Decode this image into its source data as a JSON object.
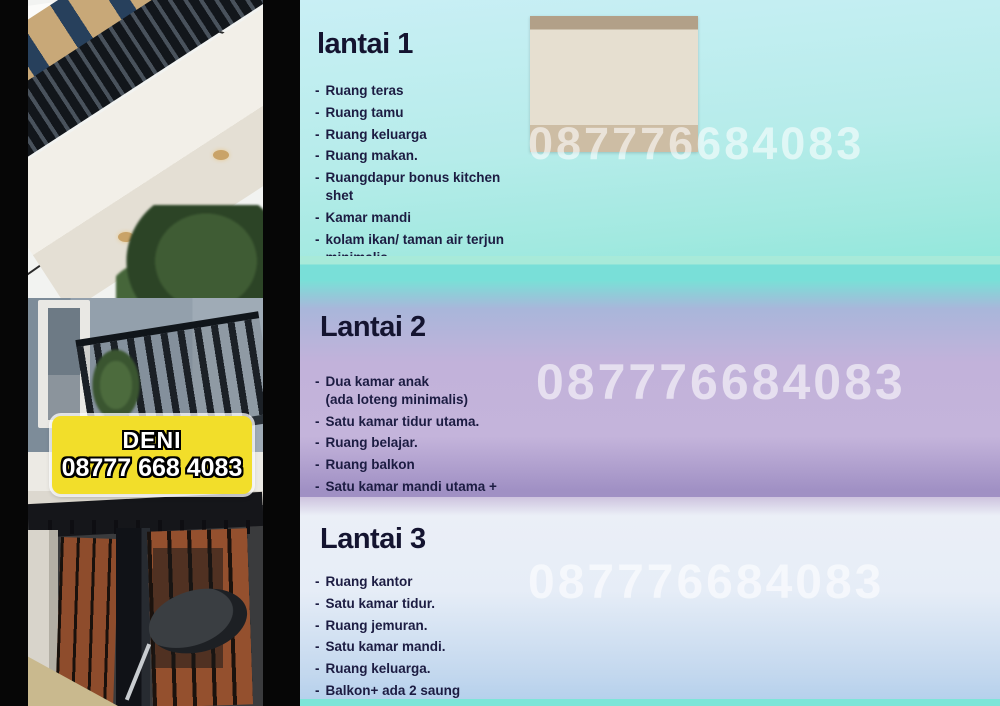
{
  "flyer": {
    "bullet": "-",
    "watermark": "087776684083",
    "badge": {
      "name": "DENI",
      "phone": "08777 668 4083"
    },
    "sections": [
      {
        "title": "lantai 1",
        "items": [
          "Ruang teras",
          "Ruang tamu",
          "Ruang keluarga",
          "Ruang makan.",
          "Ruangdapur bonus kitchen shet",
          "Kamar mandi",
          "kolam ikan/ taman air terjun minimalis.\ncarpot/garasi lantai 1tidak ada,\nhanya adanya teras depan.\n(karena tidak bisa masuk mobil)"
        ],
        "photos": [
          "entrance-double-door",
          "room-ceiling-fan",
          "stone-bathroom-door",
          "white-room",
          "kitchen-set",
          "room-electrical-panel",
          "staircase"
        ]
      },
      {
        "title": "Lantai 2",
        "items": [
          "Dua kamar anak\n(ada loteng minimalis)",
          "Satu kamar tidur utama.",
          "Ruang belajar.",
          "Ruang balkon",
          "Satu kamar mandi utama + Bathup."
        ],
        "photos": [
          "iron-stair-railing",
          "cove-ceiling-room",
          "dark-bedroom",
          "wood-attic-stairs",
          "bedroom-window",
          "bathroom-toilet-bathtub",
          "balcony-railing"
        ]
      },
      {
        "title": "Lantai 3",
        "items": [
          "Ruang kantor",
          "Satu kamar tidur.",
          "Ruang jemuran.",
          "Satu kamar mandi.",
          "Ruang keluarga.",
          "Balkon+ ada 2 saung minimalis."
        ],
        "photos": [
          "stone-wall-doors",
          "saung-gazebo",
          "wood-deck-doorway",
          "bathroom-door",
          "stone-accent-room"
        ]
      }
    ],
    "colors": {
      "section1_top": "#c9eff5",
      "section1_bottom": "#8de7da",
      "divider_teal": "#7ce4d8",
      "section2_mid": "#c3b3da",
      "section2_bottom": "#a090c4",
      "section3_top": "#ebeff7",
      "section3_bottom": "#b2cfec",
      "badge_yellow": "#f2de2a",
      "text_dark": "#1c1c42"
    }
  }
}
